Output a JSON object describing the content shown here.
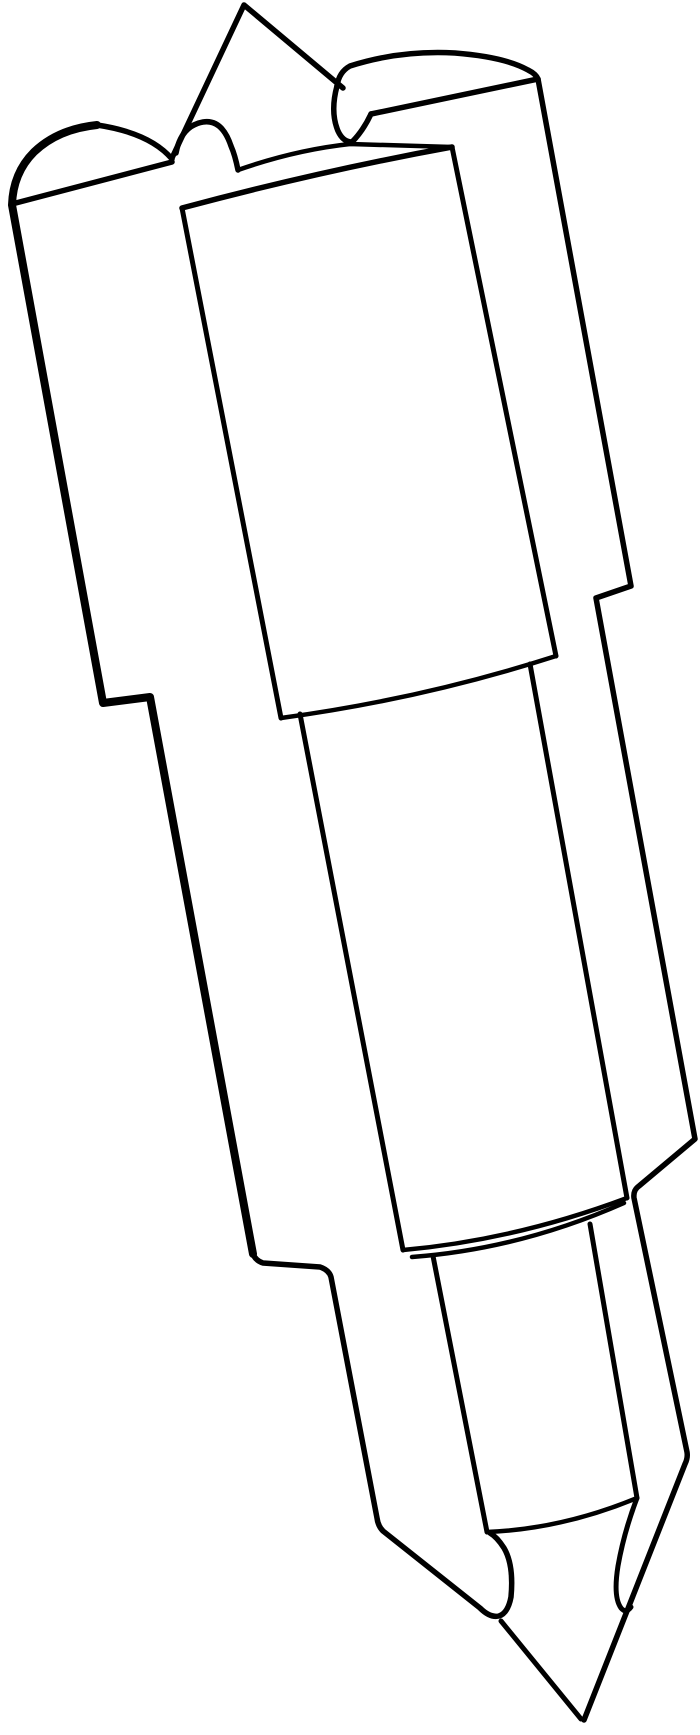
{
  "page": {
    "background_color": "#ffffff"
  },
  "drawing": {
    "description": "Black-and-white outline line drawing of a pointed, stepped cylindrical tool (nozzle/punch-like object) tilted slightly clockwise: rounded tabs and a triangular fin at the top, a wide upper cylinder, a narrower middle cylinder, a small lower cylinder, two curved prongs, and a sharp conical tip at the bottom",
    "stroke_color": "#000000",
    "background_color": "#ffffff",
    "canvas": {
      "width": 700,
      "height": 1735
    },
    "paths": [
      {
        "name": "left-silhouette-upper",
        "d": "M 97 125 Q 58 129 34 152 Q 13 173 12 205 L 103 703 L 150 697 L 253 1254",
        "width": 8
      },
      {
        "name": "left-silhouette-lower-prong",
        "d": "M 253 1254 Q 256 1261 263 1263 L 320 1267 Q 329 1270 331 1277 L 377 1518 Q 378 1526 383 1531 L 480 1608 Q 490 1618 499 1616 Q 508 1613 511 1597 Q 514 1565 504 1548 Q 497 1537 490 1533",
        "width": 5.5
      },
      {
        "name": "left-tab-back-edge",
        "d": "M 97 125 Q 150 133 172 159",
        "width": 5.5
      },
      {
        "name": "left-tab-front-edge",
        "d": "M 12 204 L 172 162",
        "width": 5.5
      },
      {
        "name": "back-fin-triangle",
        "d": "M 172 158 L 244 5 L 343 88",
        "width": 5.5
      },
      {
        "name": "front-lug-bump",
        "d": "M 176 153 Q 181 126 203 122 Q 222 119 231 146 Q 235 155 238 170",
        "width": 5.5
      },
      {
        "name": "top-face-back-edge",
        "d": "M 238 170 Q 295 150 350 144 L 452 147",
        "width": 4.5
      },
      {
        "name": "top-cleft-notch",
        "d": "M 337 86 Q 330 112 338 131 Q 343 142 352 142 Q 363 131 371 114",
        "width": 5.5
      },
      {
        "name": "right-tab",
        "d": "M 337 86 Q 339 72 350 66 Q 400 50 455 53 Q 505 57 528 70 Q 536 74 538 79 L 371 114",
        "width": 5.5
      },
      {
        "name": "top-face-front-edge",
        "d": "M 182 208 Q 320 171 452 147",
        "width": 5.5
      },
      {
        "name": "upper-cylinder-left-edge",
        "d": "M 182 208 L 281 718",
        "width": 5
      },
      {
        "name": "upper-cylinder-right-edge",
        "d": "M 452 147 L 556 656",
        "width": 5
      },
      {
        "name": "upper-cylinder-bottom-seam",
        "d": "M 281 718 Q 422 699 556 656",
        "width": 4.5
      },
      {
        "name": "mid-cylinder-left-edge",
        "d": "M 300 714 L 403 1250",
        "width": 5
      },
      {
        "name": "mid-cylinder-right-edge",
        "d": "M 530 664 L 627 1198",
        "width": 5
      },
      {
        "name": "right-silhouette-and-cone-right-edge",
        "d": "M 538 79 L 631 586 L 596 598 L 695 1139 L 639 1186 Q 633 1190 634 1198 L 687 1452 Q 688 1458 685 1464 L 584 1720",
        "width": 5.5
      },
      {
        "name": "lower-band-upper-seam",
        "d": "M 403 1250 Q 515 1240 627 1198",
        "width": 4.5
      },
      {
        "name": "lower-band-lower-seam",
        "d": "M 412 1257 Q 520 1249 624 1203",
        "width": 4.5
      },
      {
        "name": "lower-cylinder-left-edge",
        "d": "M 433 1256 L 487 1532",
        "width": 5
      },
      {
        "name": "lower-cylinder-right-edge",
        "d": "M 590 1224 L 637 1498",
        "width": 5
      },
      {
        "name": "cone-base-seam",
        "d": "M 487 1532 Q 562 1529 637 1498",
        "width": 4.5
      },
      {
        "name": "cone-left-edge",
        "d": "M 501 1621 L 581 1719",
        "width": 5
      },
      {
        "name": "right-prong-inner-edge",
        "d": "M 637 1498 Q 624 1532 618 1566 Q 613 1597 621 1608 Q 626 1614 631 1607",
        "width": 5
      }
    ]
  }
}
